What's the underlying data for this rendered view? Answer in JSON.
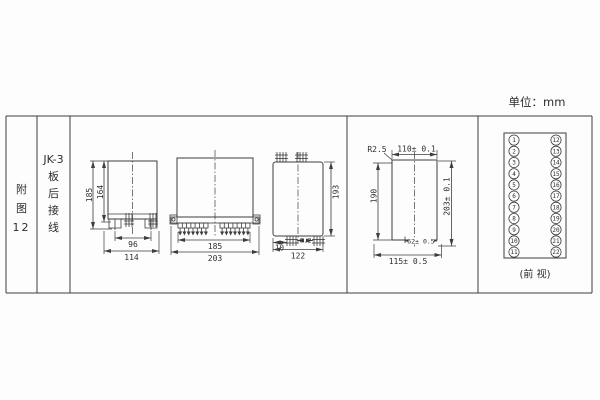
{
  "unit_label": "单位：mm",
  "index_col": {
    "c1": "附",
    "c2": "图",
    "c3": "12"
  },
  "title_col": {
    "l1": "JK-3",
    "l2": "板",
    "l3": "后",
    "l4": "接",
    "l5": "线"
  },
  "d1": {
    "h_outer": "185",
    "h_inner": "164",
    "w_inner": "96",
    "w_outer": "114"
  },
  "d2": {
    "w_inner": "185",
    "w_outer": "203"
  },
  "d3": {
    "h": "193",
    "offset": "10",
    "pitch": "6.2",
    "w": "122"
  },
  "d4": {
    "radius": "R2.5",
    "w_top": "110± 0.1",
    "h_left": "190",
    "h_right": "203± 0.1",
    "w_slot": "62± 0.5",
    "w_bottom": "115± 0.5"
  },
  "terminals": {
    "caption": "(前 视)",
    "left": [
      "1",
      "2",
      "3",
      "4",
      "5",
      "6",
      "7",
      "8",
      "9",
      "10",
      "11"
    ],
    "right": [
      "12",
      "13",
      "14",
      "15",
      "16",
      "17",
      "18",
      "19",
      "20",
      "21",
      "22"
    ]
  }
}
